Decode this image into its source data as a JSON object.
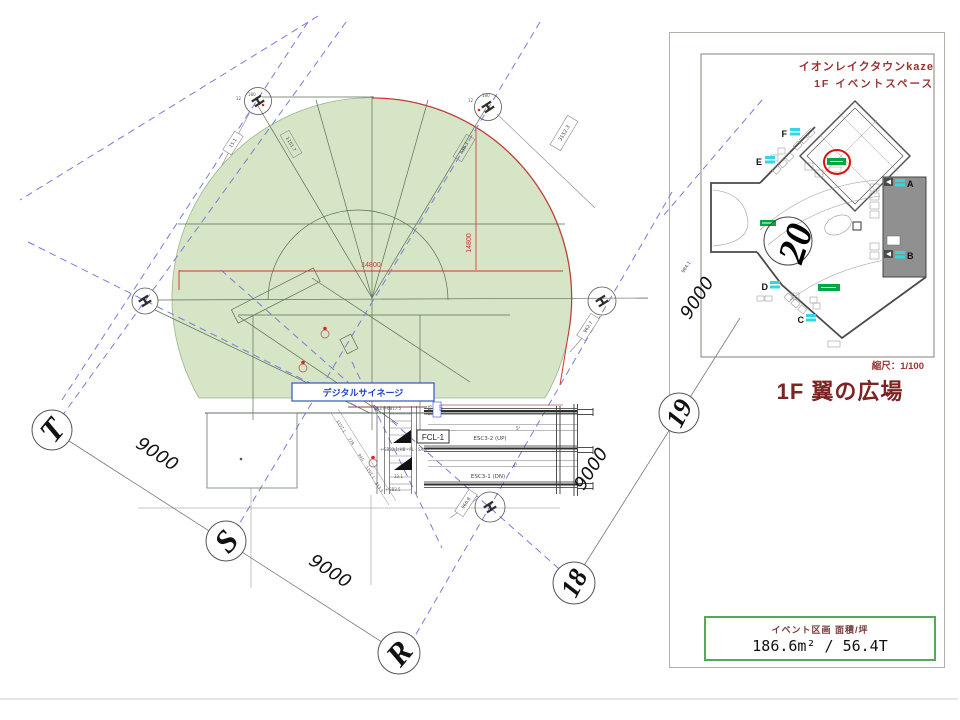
{
  "panel": {
    "map_title_line1": "イオンレイクタウンkaze",
    "map_title_line2": "1F イベントスペース",
    "scale_label": "縮尺：1/100",
    "page_title": "1F 翼の広場",
    "area_label": "イベント区画  面積/坪",
    "area_value": "186.6m² / 56.4T",
    "accent_color": "#9a3232",
    "title_color": "#7a2424",
    "area_border_color": "#55aa55"
  },
  "minimap": {
    "grid_number": "20",
    "entrance_a": "A",
    "entrance_b": "B",
    "entrance_c": "C",
    "entrance_d": "D",
    "entrance_e": "E",
    "entrance_f": "F",
    "highlight_color": "#00a844",
    "marker_color": "#2fd8e4",
    "highlight_circle_color": "#dd1111"
  },
  "drawing": {
    "dim_9000": "9000",
    "dim_14800": "14800",
    "grid_letter_t": "T",
    "grid_letter_s": "S",
    "grid_letter_r": "R",
    "grid_num_18": "18",
    "grid_num_19": "19",
    "signage_label": "デジタルサイネージ",
    "fcl_label": "FCL-1",
    "esc_up_label": "ESC3-2 (UP)",
    "esc_dn_label": "ESC3-1 (DN)",
    "deg_note_1": "5°",
    "deg_note_2": "4°",
    "note_top": "3K3.0-6B17.5",
    "note_sb": "SB16",
    "note_blue": "115",
    "note_gb": "+GB32.1(HB・FL・SA3)",
    "note_331": "33.1",
    "note_gb2": "+GB3.5",
    "dim_chain": [
      "1157.1",
      "779",
      "945",
      "1191.1",
      "813.5"
    ],
    "dim_col_1": "15.1",
    "dim_col_2": "1151.7",
    "dim_col_3": "836.3",
    "dim_col_4": "3152.3",
    "dim_col_5": "962.7",
    "dim_col_6": "966.8",
    "dim_col_7": "984.1",
    "col_tick_a": "12",
    "col_tick_b": "180",
    "green_fill": "#d6e5c6",
    "red_color": "#cc3333",
    "dash_color": "#7b7bdb"
  }
}
